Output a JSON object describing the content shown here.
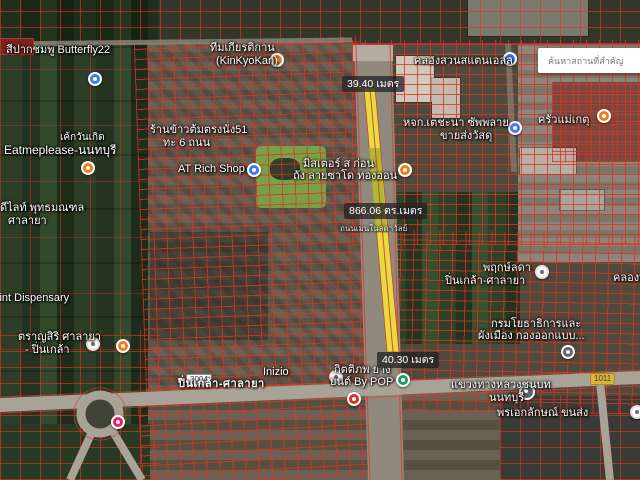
{
  "search": {
    "placeholder": "ค้นหาสถานที่สำคัญ"
  },
  "measurements": {
    "top": "39.40 เมตร",
    "mid": "866.06 ตร.เมตร",
    "bottom": "40.30 เมตร"
  },
  "shields": {
    "left": "3004",
    "right": "1011"
  },
  "labels": [
    {
      "line1": "สีปากชมพู Butterfly22"
    },
    {
      "line1": "ทีมเกียรติกาน",
      "line2": "(KinKyoKan)"
    },
    {
      "line1": "คลองสวนสแตนเอลล"
    },
    {
      "line1": "เค้กวันเกิด",
      "line2": "Eatmeplease-นนทบุรี"
    },
    {
      "line1": "ร้านข้าวต้มตรงนั่ง51",
      "line2": "ทะ 6 ถนน"
    },
    {
      "line1": "AT Rich Shop"
    },
    {
      "line1": "มิสเตอร์ ส ก่อน",
      "line2": "ถัง ลายซาโด ทองออน"
    },
    {
      "line1": "หจก.เตชะนา ซัพพลาย",
      "line2": "ขายส่งวัสดุ"
    },
    {
      "line1": "ครัวแม่เกตุ"
    },
    {
      "line1": "ดีไลท์ พุทธมณฑล",
      "line2": "ศาลายา"
    },
    {
      "line1": "พฤกษ์ลดา",
      "line2": "ปิ่นเกล้า-ศาลายา"
    },
    {
      "line1": "Point Dispensary"
    },
    {
      "line1": "ตราญสิริ ศาลายา",
      "line2": "- ปิ่นเกล้า"
    },
    {
      "line1": "กรมโยธาธิการและ",
      "line2": "ผังเมือง กองออกแบบ..."
    },
    {
      "line1": "Inizio"
    },
    {
      "line1": "ปิ่นเกล้า-ศาลายา"
    },
    {
      "line1": "กิตติภพ ยาง",
      "line2": "ยนต์ By POP"
    },
    {
      "line1": "แขวงทางหลวงชนบท",
      "line2": "นนทบุรี"
    },
    {
      "line1": "พรเอกลักษณ์ ขนส่ง"
    },
    {
      "line1": "ถนนเมนในลดาวัลย์"
    },
    {
      "line1": "คลองบ"
    }
  ],
  "icons": {
    "blue_marker": "#4179f1",
    "orange_marker": "#f07d1a",
    "white_marker": "#ffffff",
    "green_marker": "#1e9e63",
    "gray_marker": "#5f6368",
    "pink_marker": "#e91e63",
    "fuel_marker": "#d93025"
  },
  "colors": {
    "parcel_line": "#e32f24",
    "highlight_yellow": "#eee33e",
    "highlight_olive": "#a9b832",
    "badge_bg": "#202124",
    "search_bg": "#ffffff"
  }
}
